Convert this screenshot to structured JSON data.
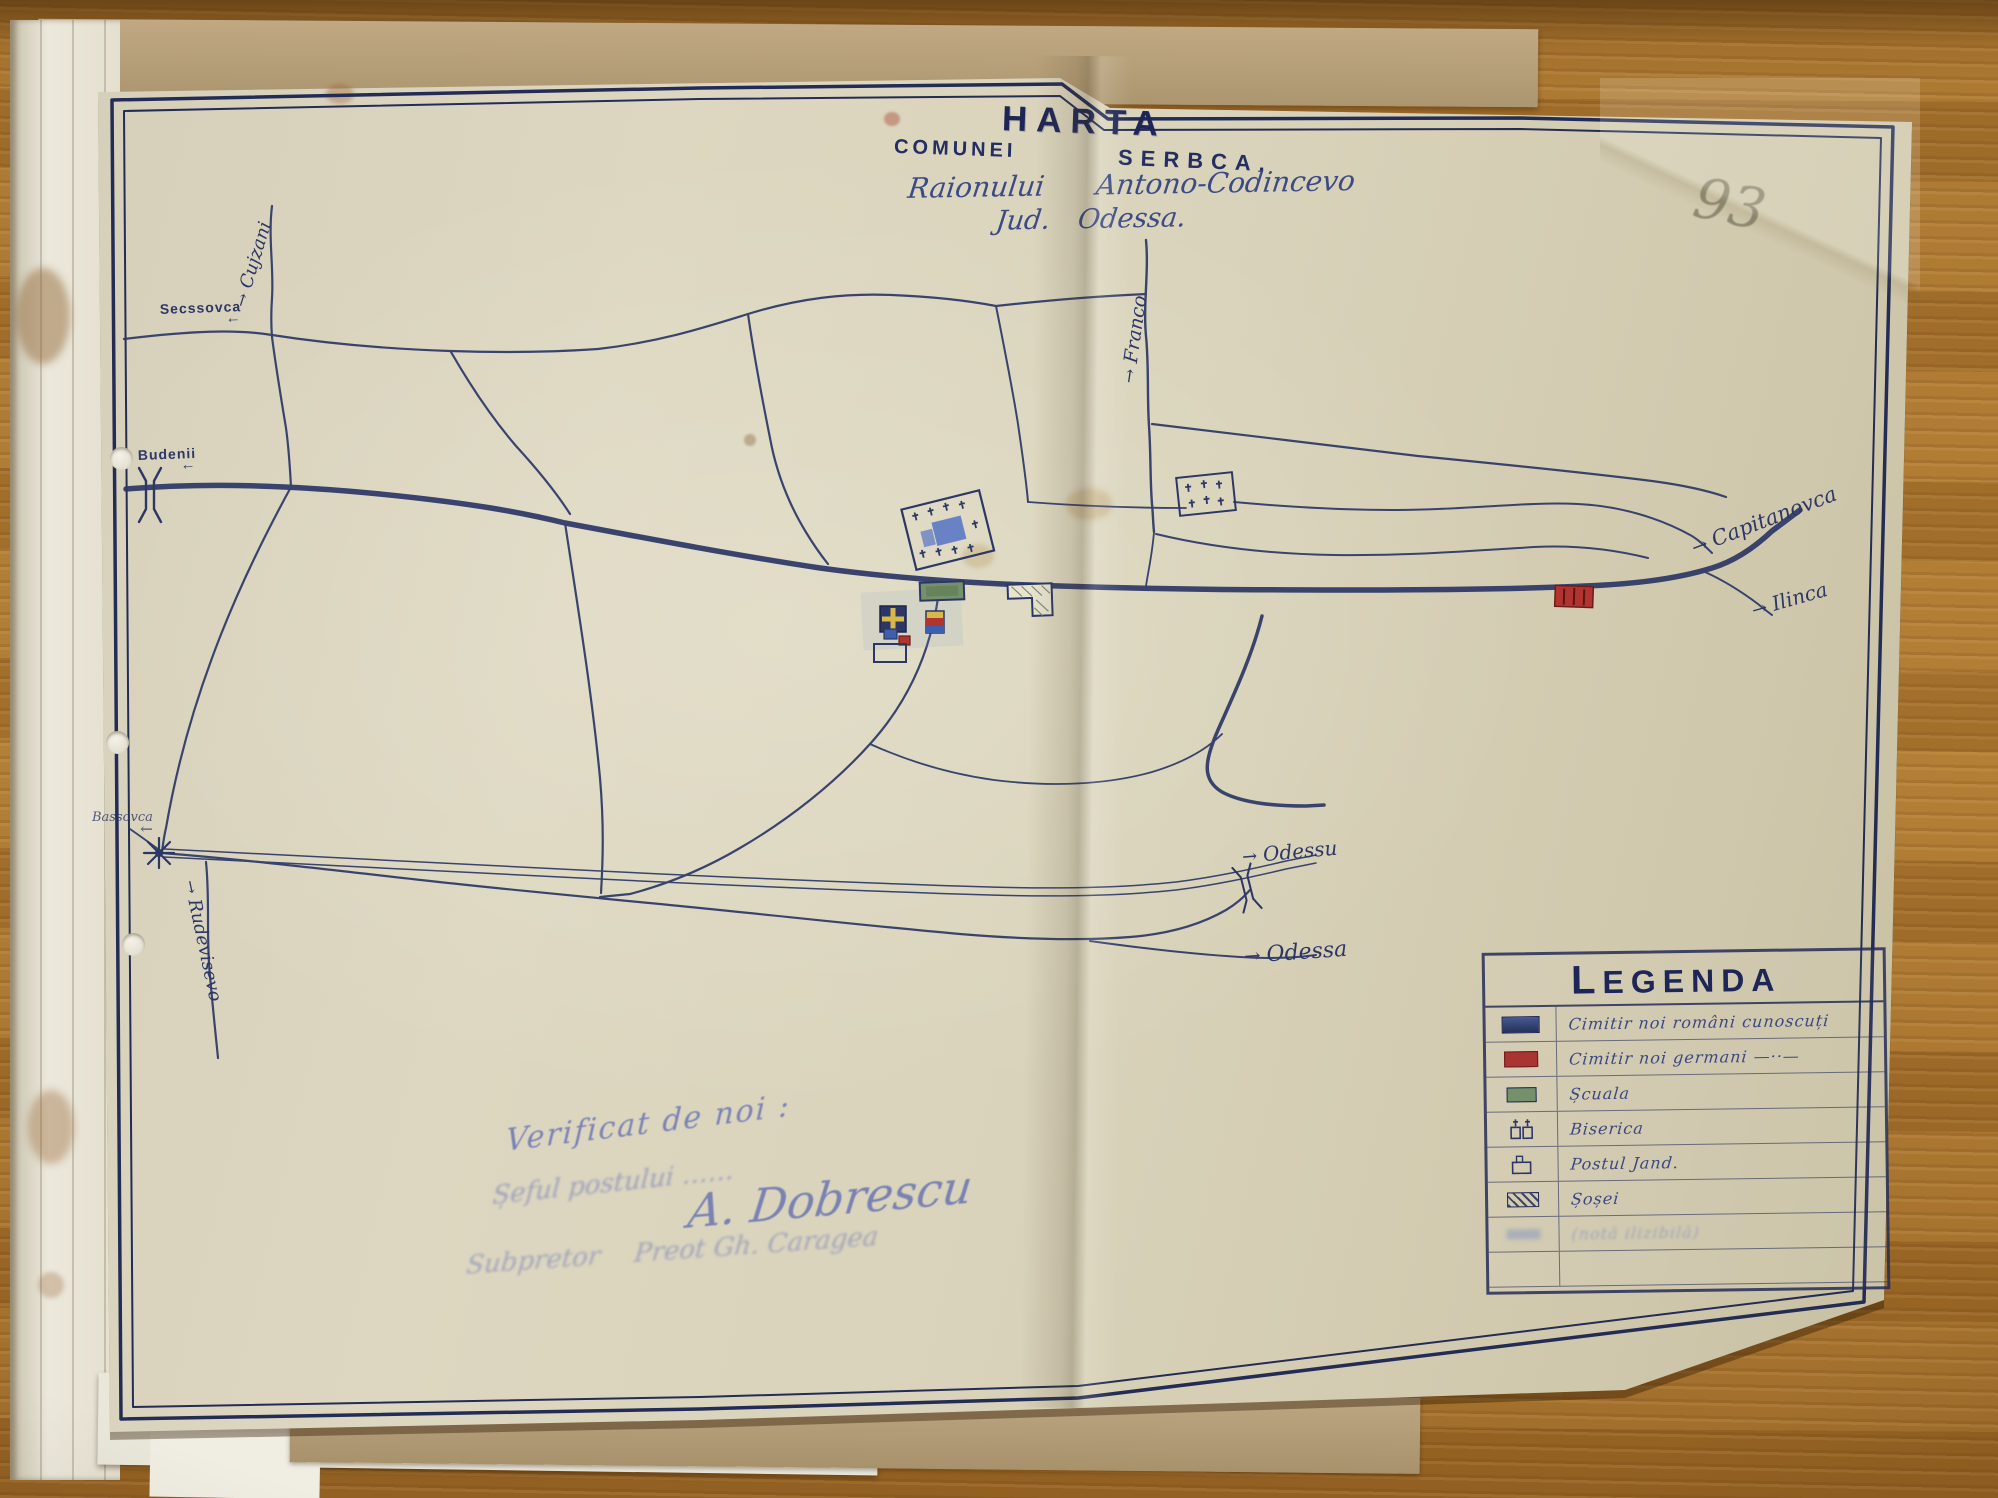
{
  "photo": {
    "pencil_page_number": "93"
  },
  "title": {
    "word_harta": "HARTA",
    "word_comunei": "COMUNEI",
    "word_serbca": "SERBCA.",
    "raion_label": "Raionului",
    "raion_name": "Antono-Codincevo",
    "jud_label": "Jud.",
    "jud_name": "Odessa."
  },
  "labels": {
    "cujzani": {
      "text": "Cujzani",
      "arrow": "→"
    },
    "secssovca": {
      "text": "Secssovca",
      "arrow": "←"
    },
    "budenii": {
      "text": "Budenii",
      "arrow": "←"
    },
    "franco": {
      "text": "Franco",
      "arrow": "→"
    },
    "capitanovca": {
      "text": "Capitanovca",
      "arrow": "→"
    },
    "ilinca": {
      "text": "Ilinca",
      "arrow": "→"
    },
    "odessu": {
      "text": "Odessu",
      "arrow": "→"
    },
    "odessa": {
      "text": "Odessa",
      "arrow": "→"
    },
    "bassovca": {
      "text": "Bassovca",
      "arrow": "←"
    },
    "rudevisevo": {
      "text": "Rudevisevo",
      "arrow": "→"
    }
  },
  "legend": {
    "title": "LEGENDA",
    "rows": [
      {
        "symbol": "romanian-cemetery-swatch",
        "label": "Cimitir noi români cunoscuți"
      },
      {
        "symbol": "german-cemetery-swatch",
        "label": "Cimitir noi germani —··—"
      },
      {
        "symbol": "school-swatch",
        "label": "Șcuala"
      },
      {
        "symbol": "church-symbol",
        "label": "Biserica"
      },
      {
        "symbol": "gendarme-post-symbol",
        "label": "Postul Jand."
      },
      {
        "symbol": "highway-swatch",
        "label": "Șoșei"
      },
      {
        "symbol": "pencil-note",
        "label": "(notă ilizibilă)"
      }
    ]
  },
  "verification": {
    "line1": "Verificat de noi :",
    "line2": "Șeful postului ……",
    "signature": "A. Dobrescu",
    "line3a": "Subpretor",
    "line3b": "Preot Gh. Caragea"
  },
  "map_symbols": [
    {
      "name": "romanian-cemetery",
      "color": "#46598f"
    },
    {
      "name": "german-cemetery",
      "color": "#a83531"
    },
    {
      "name": "school",
      "color": "#75916b"
    },
    {
      "name": "church",
      "color": "#d8b84a"
    },
    {
      "name": "gendarme-post",
      "color": "#2c3766"
    }
  ],
  "colors": {
    "ink_navy": "#2c3766",
    "handwriting_blue": "#6a74b4",
    "paper": "#d9d3bd",
    "wood": "#a9762f",
    "cemetery_red": "#a83531",
    "school_green": "#75916b",
    "church_gold": "#d8b84a"
  }
}
